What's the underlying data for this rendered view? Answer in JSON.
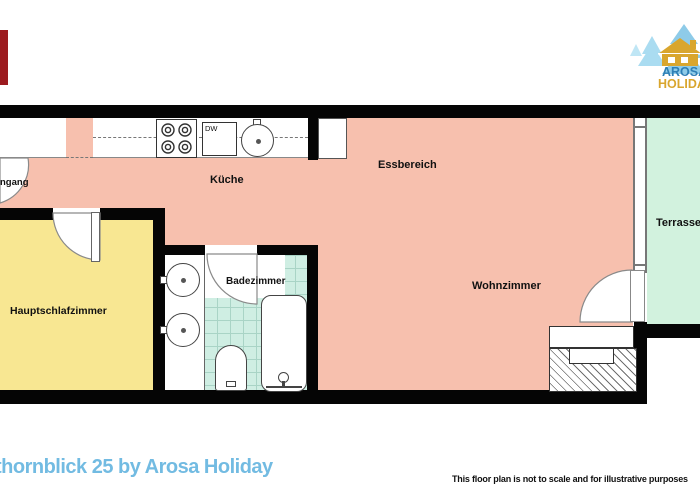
{
  "footer": {
    "title": "thornblick 25 by Arosa Holiday",
    "title_color": "#72bbe2",
    "disclaimer": "This floor plan is not to scale and for illustrative purposes"
  },
  "logo": {
    "line1": "AROSA",
    "line2": "HOLIDAY",
    "line1_color": "#2e7fb5",
    "line2_color": "#d9a62e",
    "tree_color": "#8ecbe8",
    "house_color": "#d9a62e"
  },
  "floorplan": {
    "wall_color": "#050505",
    "accent_bar_color": "#9c1b1f",
    "rooms": {
      "kitchen": {
        "label": "Küche",
        "color": "#f7c0ae"
      },
      "dining": {
        "label": "Essbereich",
        "color": "#f7c0ae"
      },
      "living": {
        "label": "Wohnzimmer",
        "color": "#f7c0ae"
      },
      "terrace": {
        "label": "Terrasse",
        "color": "#d2f2de"
      },
      "bedroom": {
        "label": "Hauptschlafzimmer",
        "color": "#f8e792"
      },
      "bathroom": {
        "label": "Badezimmer",
        "color": "#cfeee3"
      },
      "entrance": {
        "label": "ngang",
        "color": "#ffffff"
      }
    },
    "fixtures": {
      "dishwasher": "DW"
    }
  }
}
